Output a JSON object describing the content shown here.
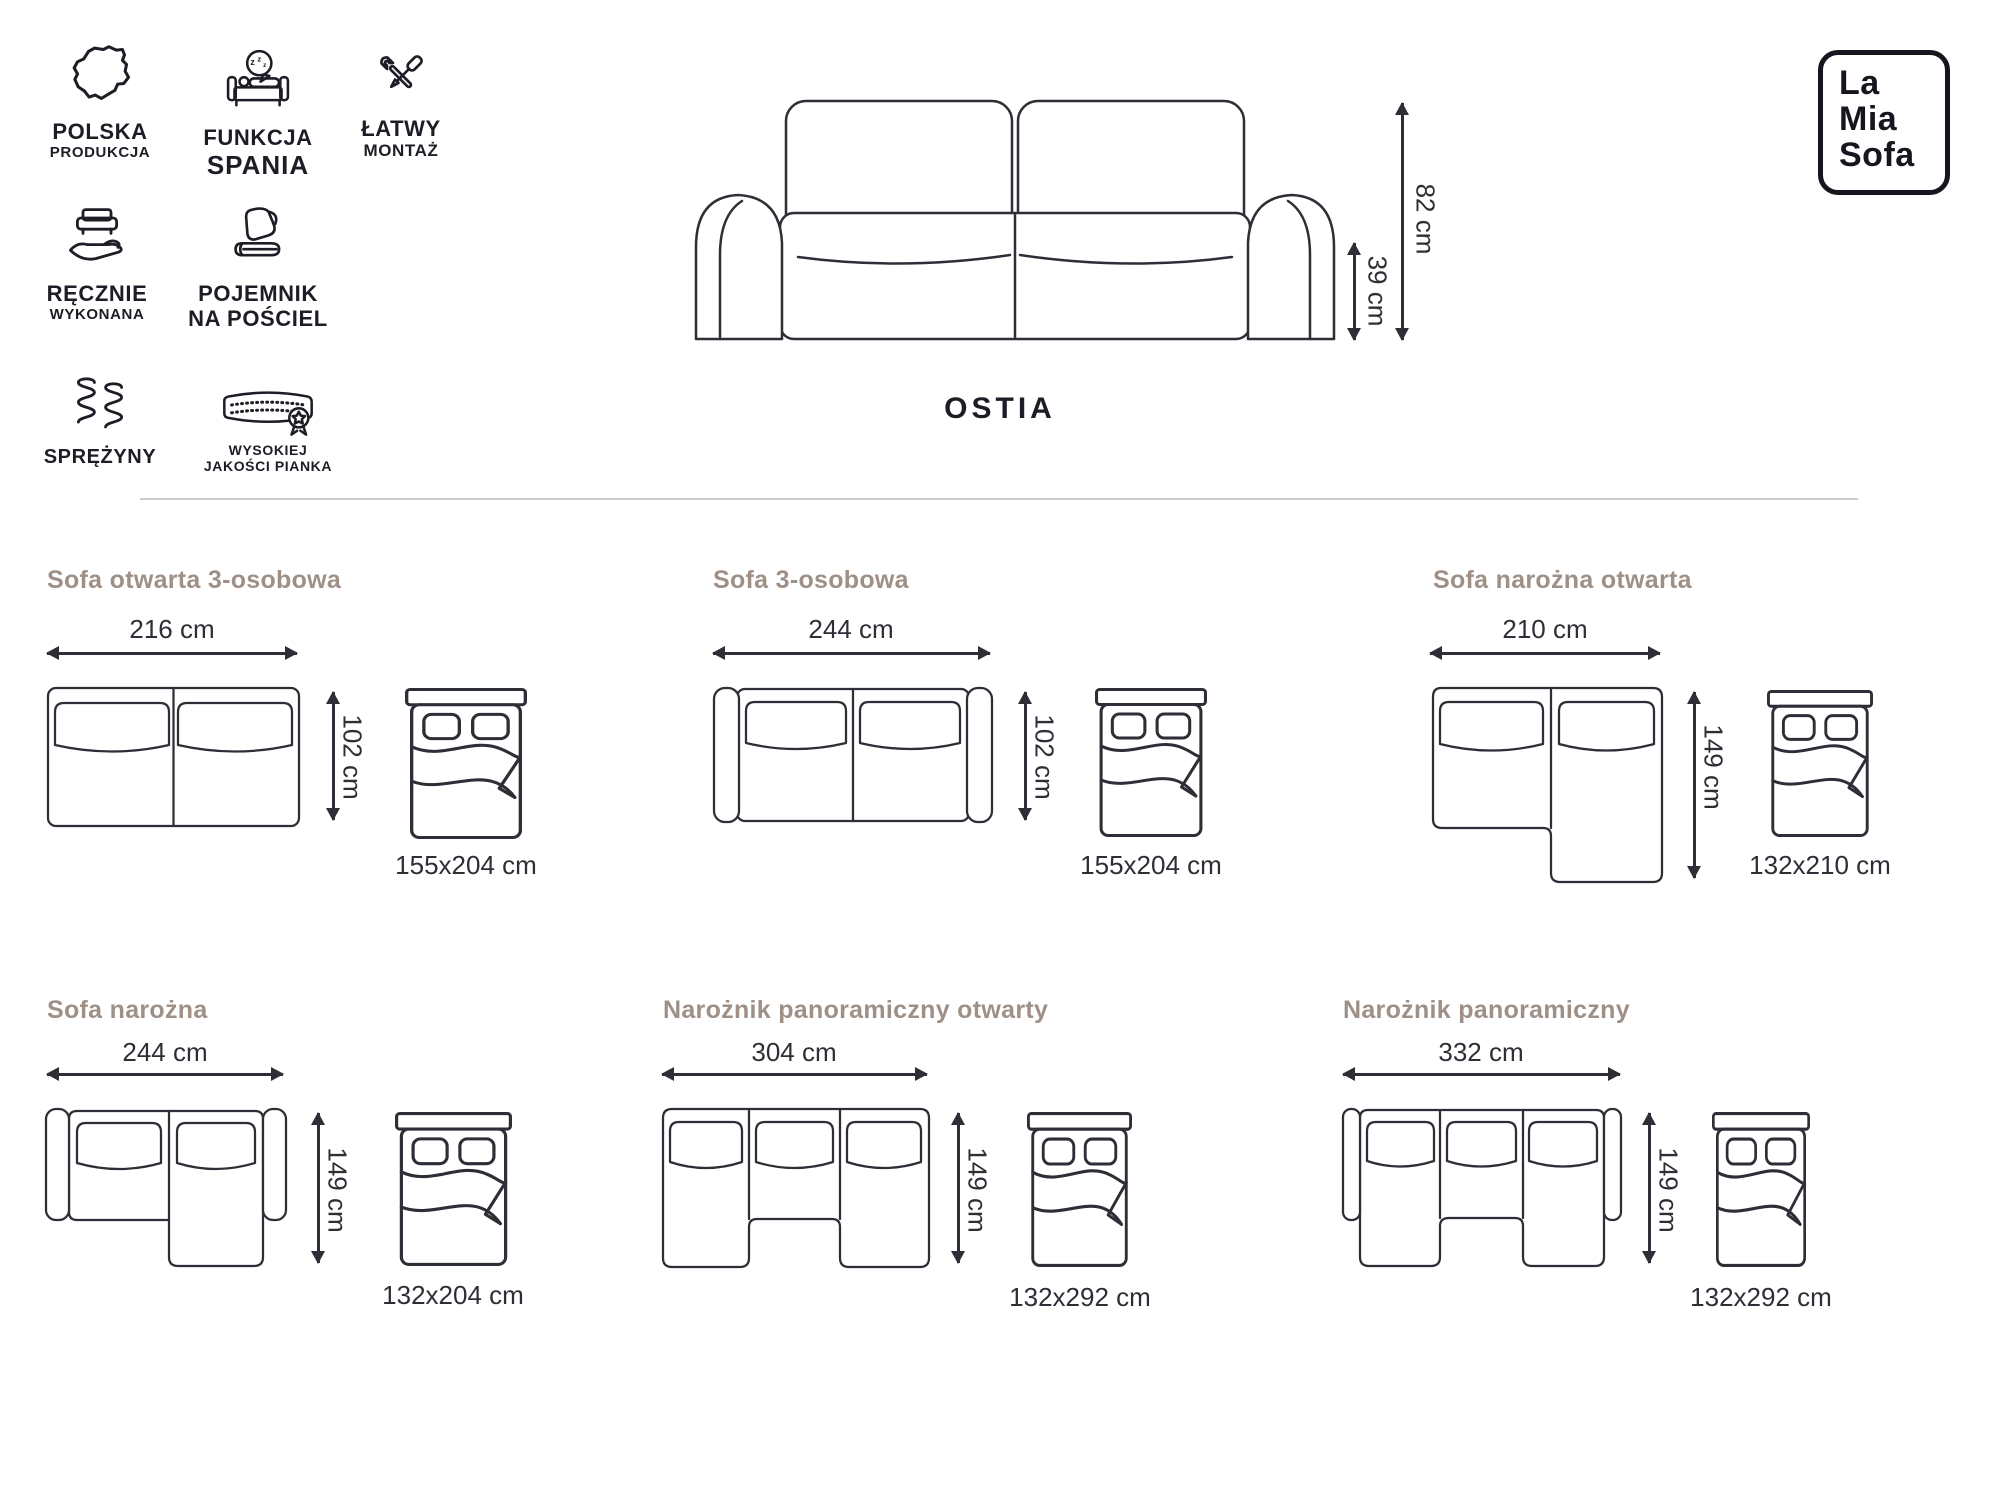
{
  "header": {
    "features": [
      {
        "icon": "poland-map-icon",
        "line1": "POLSKA",
        "line2": "PRODUKCJA"
      },
      {
        "icon": "sleep-function-icon",
        "line1": "FUNKCJA",
        "line2": "SPANIA"
      },
      {
        "icon": "easy-assembly-icon",
        "line1": "ŁATWY",
        "line2": "MONTAŻ"
      },
      {
        "icon": "handmade-icon",
        "line1": "RĘCZNIE",
        "line2": "WYKONANA"
      },
      {
        "icon": "bedding-storage-icon",
        "line1": "POJEMNIK",
        "line2": "NA POŚCIEL"
      },
      {
        "icon": "springs-icon",
        "line1": "SPRĘŻYNY",
        "line2": ""
      },
      {
        "icon": "foam-quality-icon",
        "line1": "WYSOKIEJ",
        "line2": "JAKOŚCI PIANKA"
      }
    ],
    "logo": {
      "line1": "La",
      "line2": "Mia",
      "line3": "Sofa"
    },
    "product_name": "OSTIA",
    "total_height": "82 cm",
    "seat_height": "39 cm"
  },
  "panels": [
    {
      "title": "Sofa otwarta 3-osobowa",
      "width": "216 cm",
      "depth": "102 cm",
      "bed": "155x204 cm"
    },
    {
      "title": "Sofa 3-osobowa",
      "width": "244 cm",
      "depth": "102 cm",
      "bed": "155x204 cm"
    },
    {
      "title": "Sofa narożna otwarta",
      "width": "210 cm",
      "depth": "149 cm",
      "bed": "132x210 cm"
    },
    {
      "title": "Sofa narożna",
      "width": "244 cm",
      "depth": "149 cm",
      "bed": "132x204 cm"
    },
    {
      "title": "Narożnik panoramiczny otwarty",
      "width": "304 cm",
      "depth": "149 cm",
      "bed": "132x292 cm"
    },
    {
      "title": "Narożnik panoramiczny",
      "width": "332 cm",
      "depth": "149 cm",
      "bed": "132x292 cm"
    }
  ],
  "colors": {
    "line": "#2e2e36",
    "icon": "#1d1d26",
    "panel_title": "#9e9087",
    "divider": "#cbcbcb",
    "background": "#ffffff"
  }
}
